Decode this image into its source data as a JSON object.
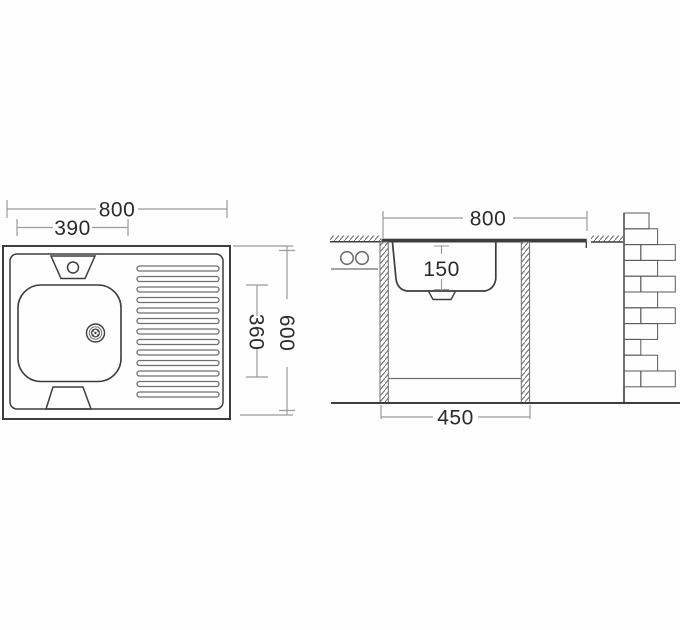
{
  "views": {
    "top_view": {
      "overall_width_mm": "800",
      "bowl_width_mm": "390",
      "bowl_depth_mm": "360",
      "overall_depth_mm": "600"
    },
    "side_view": {
      "overall_width_mm": "800",
      "bowl_height_mm": "150",
      "stand_width_mm": "450"
    }
  },
  "colors": {
    "bg": "#fefefe",
    "line": "#3d3d3d",
    "mid": "#6f6f6f",
    "dim": "#9b9b9b",
    "brick": "#5a5a5a",
    "text": "#2b2b2b"
  }
}
